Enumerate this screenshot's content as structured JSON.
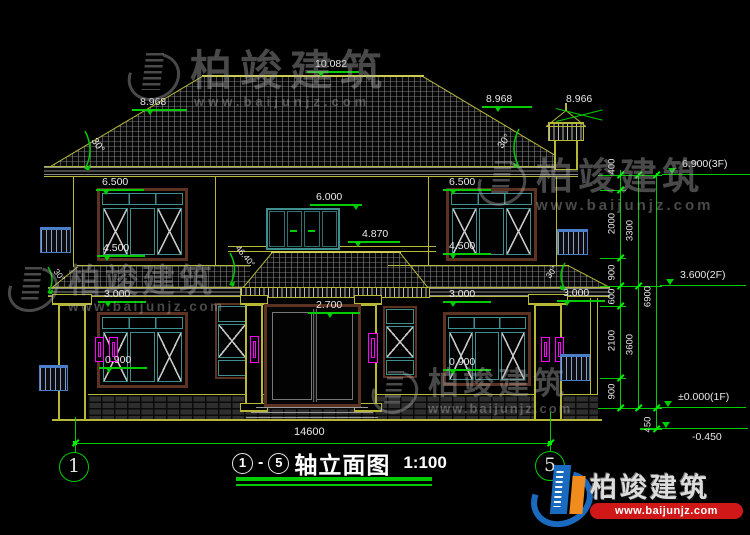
{
  "drawing": {
    "title": {
      "axis_start": "1",
      "dash": "-",
      "axis_end": "5",
      "name": "轴立面图",
      "scale": "1:100"
    },
    "grid": {
      "left": "1",
      "right": "5"
    },
    "dims": {
      "ridge": "10.082",
      "eave_l": "8.968",
      "eave_r": "8.968",
      "chimney": "8.966",
      "w2_head_l": "6.500",
      "w2_sill_l": "4.500",
      "w2_head_r": "6.500",
      "w2_sill_r": "4.500",
      "door2_head": "6.000",
      "porch_top": "4.870",
      "porch_l": "3.000",
      "porch_r": "3.000",
      "porch_fr": "3.000",
      "door_head": "2.700",
      "w1_sill_l": "0.900",
      "w1_sill_r": "0.900",
      "total_width": "14600"
    },
    "angles": {
      "main_l": "30°",
      "main_r": "30°",
      "porch_l": "30°",
      "porch_r": "30°",
      "center": "46.40°"
    },
    "levels": {
      "f3": "6.900(3F)",
      "f2": "3.600(2F)",
      "f1": "±0.000(1F)",
      "base": "-0.450"
    },
    "chain": {
      "c400": "400",
      "c2000": "2000",
      "c900a": "900",
      "c600": "600",
      "c2100": "2100",
      "c900b": "900",
      "c450": "450",
      "c3300": "3300",
      "c3600": "3600",
      "c6900": "6900"
    }
  },
  "watermark": {
    "brand": "柏竣建筑",
    "url": "www.baijunjz.com"
  },
  "logo": {
    "brand": "柏竣建筑",
    "url": "www.baijunjz.com"
  },
  "colors": {
    "dim_green": "#00cc00",
    "cad_olive": "#b8b838",
    "window_teal": "#3f8f8f",
    "decor_magenta": "#ff00ff",
    "railing_blue": "#4a7ec8",
    "logo_blue": "#1a6abf",
    "logo_orange": "#f08c1e",
    "logo_red": "#d01818"
  }
}
